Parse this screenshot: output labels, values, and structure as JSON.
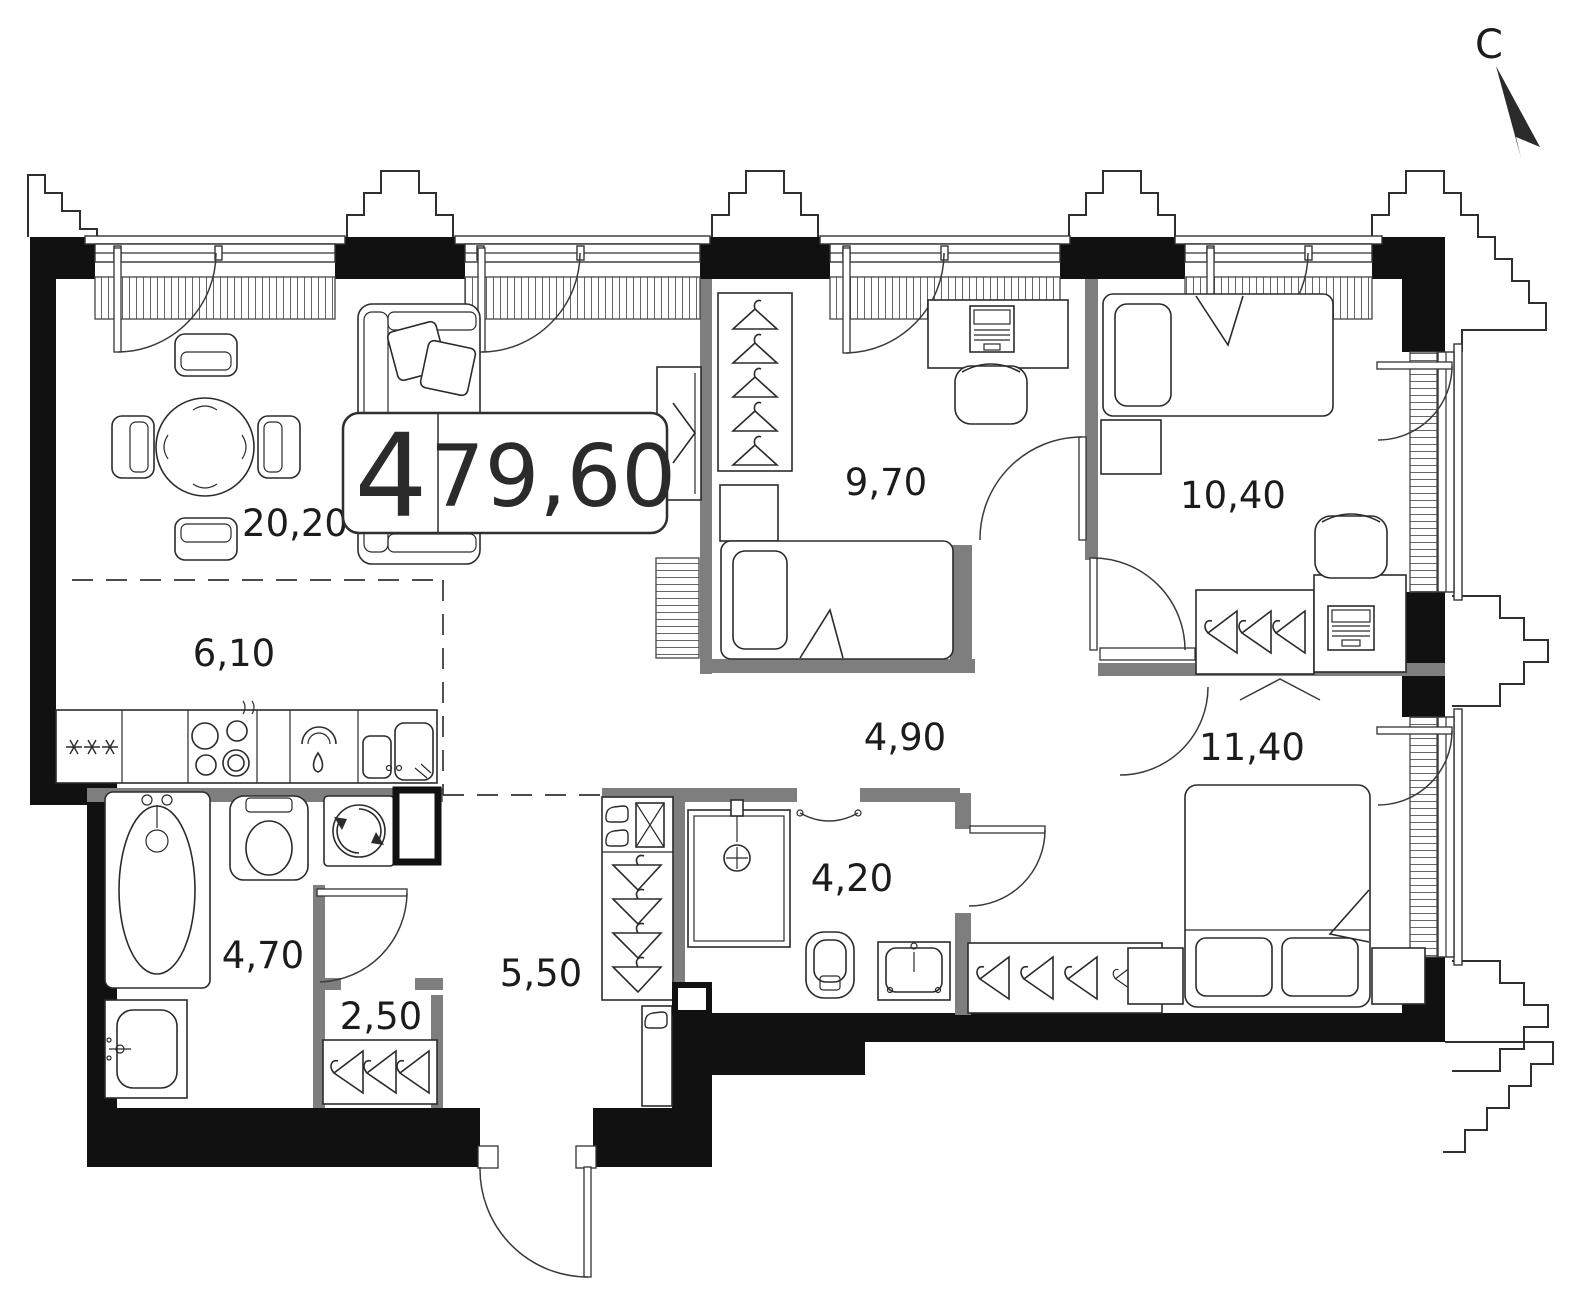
{
  "plan": {
    "badge": {
      "rooms_count": "4",
      "total_area": "79,60"
    },
    "compass": {
      "north_label": "С"
    },
    "rooms": [
      {
        "id": "living-dining",
        "area": "20,20"
      },
      {
        "id": "kitchen-niche",
        "area": "6,10"
      },
      {
        "id": "bedroom-1",
        "area": "9,70"
      },
      {
        "id": "bedroom-2",
        "area": "10,40"
      },
      {
        "id": "corridor",
        "area": "4,90"
      },
      {
        "id": "master-bedroom",
        "area": "11,40"
      },
      {
        "id": "bathroom",
        "area": "4,70"
      },
      {
        "id": "closet",
        "area": "2,50"
      },
      {
        "id": "entry-hall",
        "area": "5,50"
      },
      {
        "id": "shower-room",
        "area": "4,20"
      }
    ],
    "colors": {
      "outer_wall": "#111111",
      "partition": "#7e7e7e",
      "line": "#2b2b2b",
      "background": "#ffffff"
    }
  }
}
